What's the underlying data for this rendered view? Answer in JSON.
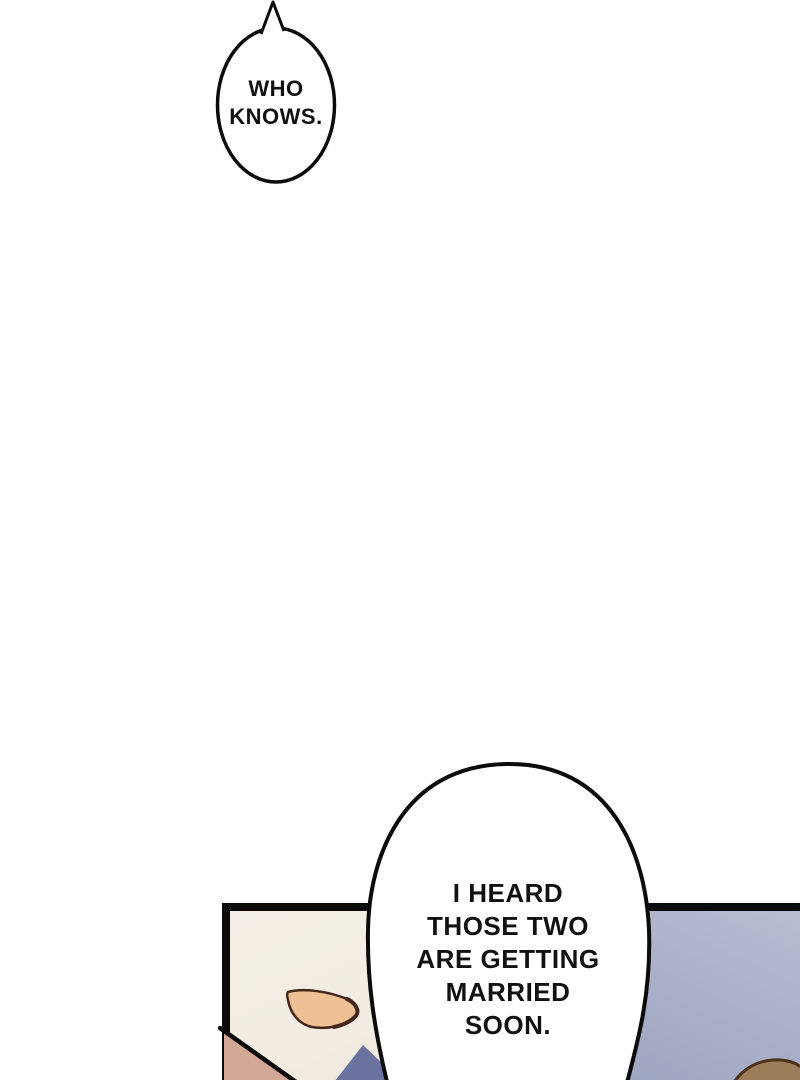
{
  "comic": {
    "top_bubble": {
      "text": "WHO\nKNOWS."
    },
    "panel_bubble": {
      "text": "I HEARD\nTHOSE TWO\nARE GETTING\nMARRIED\nSOON."
    }
  },
  "colors": {
    "ink": "#0b0b0b",
    "bubble_fill": "#ffffff",
    "face_skin_cream": "#f2ece2",
    "eye_fill": "#f0c095",
    "eye_outline": "#44261a",
    "shoulder_skin": "#d2a795",
    "clothing_navy": "#6b74a1",
    "background_lavender": "#a8aec7",
    "hair_fill": "#9d7c5a",
    "hair_outline": "#4f3018",
    "text_color": "#111111"
  }
}
